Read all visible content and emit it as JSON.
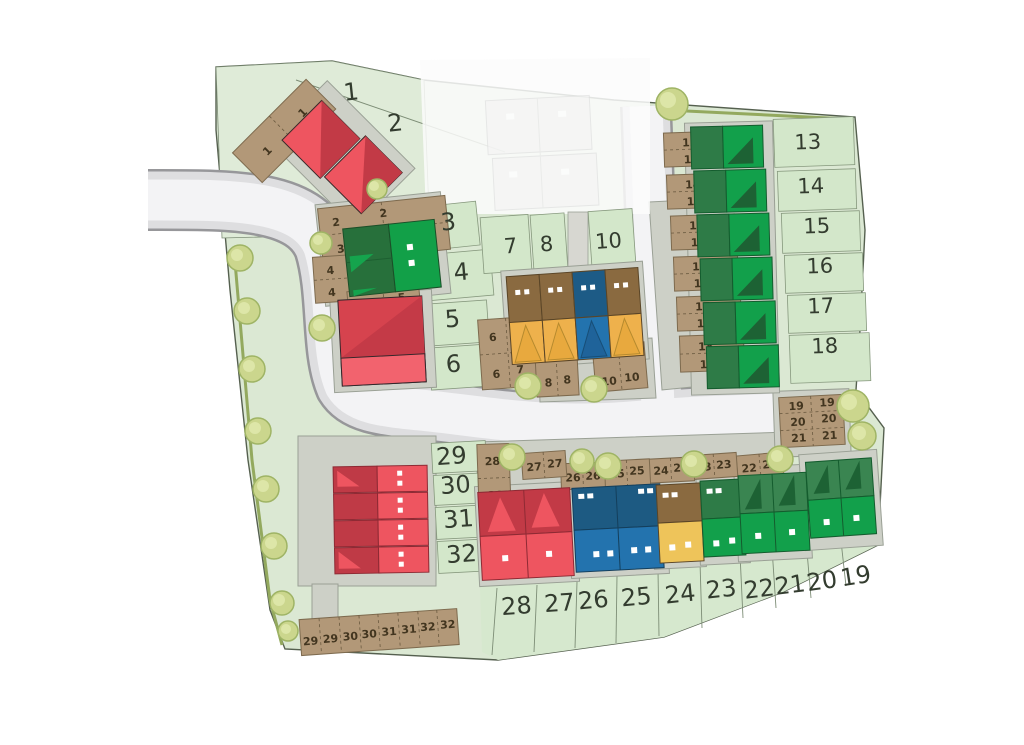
{
  "site": {
    "kind": "new-build housing development site plan",
    "background": "#ffffff"
  },
  "plots": {
    "1": "1",
    "2": "2",
    "3": "3",
    "4": "4",
    "5": "5",
    "6": "6",
    "7": "7",
    "8": "8",
    "10": "10",
    "13": "13",
    "14": "14",
    "15": "15",
    "16": "16",
    "17": "17",
    "18": "18",
    "19": "19",
    "20": "20",
    "21": "21",
    "22": "22",
    "23": "23",
    "24": "24",
    "25": "25",
    "26": "26",
    "27": "27",
    "28": "28",
    "29": "29",
    "30": "30",
    "31": "31",
    "32": "32"
  },
  "parking": {
    "1": [
      "1",
      "1"
    ],
    "2": [
      "2",
      "2"
    ],
    "3": [
      "3",
      "3"
    ],
    "4": [
      "4",
      "4"
    ],
    "5": [
      "5",
      "5"
    ],
    "6": [
      "6",
      "6"
    ],
    "7": [
      "7",
      "7"
    ],
    "8": [
      "8",
      "8"
    ],
    "10": [
      "10",
      "10"
    ],
    "13": [
      "13",
      "13"
    ],
    "14": [
      "14",
      "14"
    ],
    "15": [
      "15",
      "15"
    ],
    "16": [
      "16",
      "16"
    ],
    "17": [
      "17",
      "17"
    ],
    "18": [
      "18",
      "18"
    ],
    "19": [
      "19",
      "19"
    ],
    "20": [
      "20",
      "20"
    ],
    "21": [
      "21",
      "21"
    ],
    "22": [
      "22",
      "22"
    ],
    "23": [
      "23",
      "23"
    ],
    "24": [
      "24",
      "24"
    ],
    "25": [
      "25",
      "25"
    ],
    "26": [
      "26",
      "26"
    ],
    "27": [
      "27",
      "27"
    ],
    "28": [
      "28",
      "28"
    ],
    "29": [
      "29",
      "29"
    ],
    "30": [
      "30",
      "30"
    ],
    "31": [
      "31",
      "31"
    ],
    "32": [
      "32",
      "32"
    ]
  },
  "colors": {
    "site_green": "#dbe8d3",
    "garden_green": "#d3e7ca",
    "road_surface": "#f3f3f5",
    "road_curb": "#dedee0",
    "parking_brown": "#b29878",
    "house_red": "#ee5560",
    "house_red_dark": "#c23a46",
    "house_green": "#12a04b",
    "house_green_dark": "#2e7b47",
    "house_blue": "#2373ae",
    "house_blue_dark": "#1d5a82",
    "house_brown": "#8a6a40",
    "house_yellow": "#eeb14c",
    "tree": "#cbd68d",
    "label_text": "#333c2f",
    "parking_text": "#42351f"
  }
}
